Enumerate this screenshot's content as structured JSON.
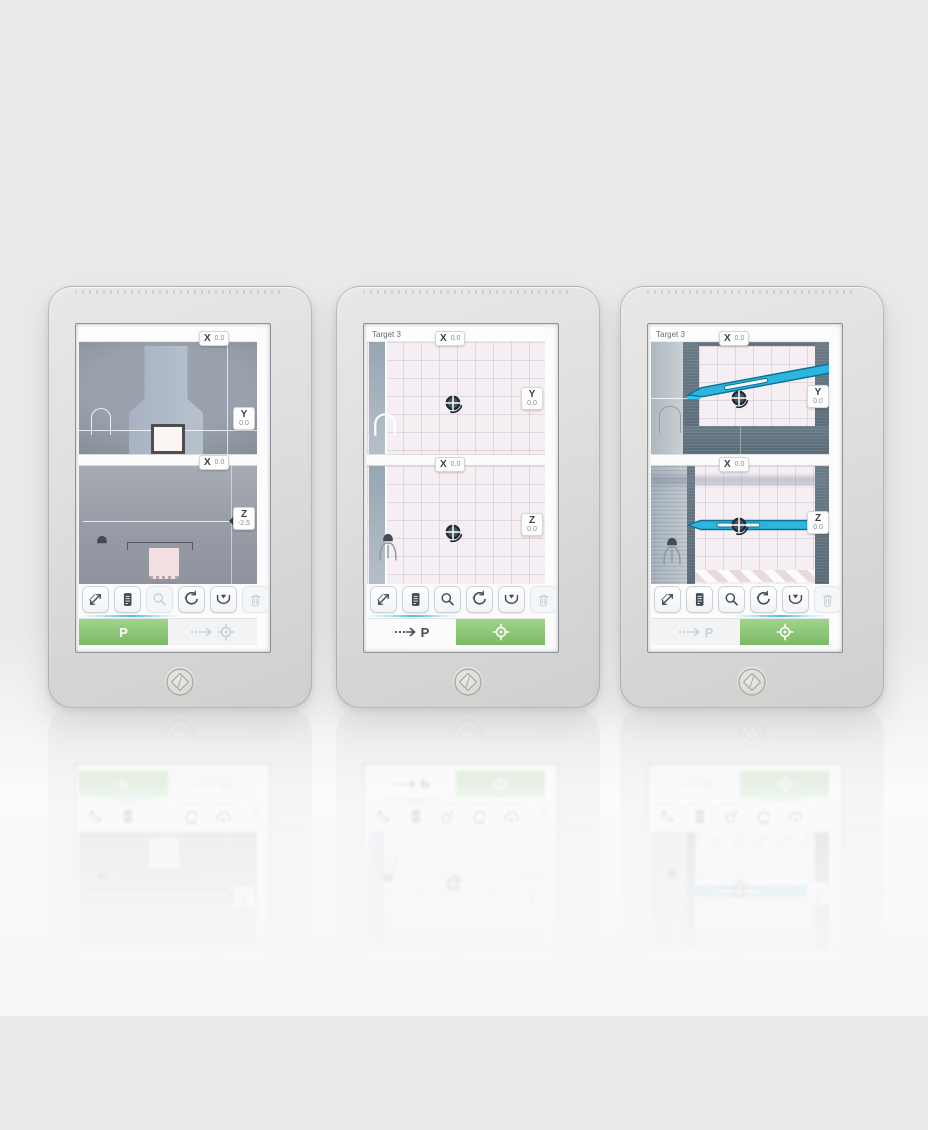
{
  "colors": {
    "accent_green": "#8CC878",
    "needle_blue": "#2CB6DE",
    "progress_cyan": "#49C3DE",
    "slate_frame": "#61727F",
    "grid_pink": "#F5EFF4",
    "body_gray": "#DEDEDC"
  },
  "icon_names": [
    "measure-icon",
    "document-icon",
    "magnifier-icon",
    "reset-icon",
    "capture-icon",
    "trash-icon",
    "dashed-arrow-icon",
    "crosshair-target-icon",
    "person-icon",
    "probe-arch-icon",
    "needle-graphic",
    "target-reticle-icon",
    "diamond-logo-icon"
  ],
  "devices": [
    {
      "title": "",
      "panels": [
        {
          "top_tag": {
            "label": "X",
            "value": "0.0"
          },
          "side_tag": {
            "label": "Y",
            "value": "0.0"
          }
        },
        {
          "top_tag": {
            "label": "X",
            "value": "0.0"
          },
          "side_tag": {
            "label": "Z",
            "value": "-2.5"
          }
        }
      ],
      "footer": {
        "probe_label": "P"
      }
    },
    {
      "title": "Target 3",
      "panels": [
        {
          "top_tag": {
            "label": "X",
            "value": "0.0"
          },
          "side_tag": {
            "label": "Y",
            "value": "0.0"
          }
        },
        {
          "top_tag": {
            "label": "X",
            "value": "0.0"
          },
          "side_tag": {
            "label": "Z",
            "value": "0.0"
          }
        }
      ],
      "footer": {
        "probe_label": "P"
      }
    },
    {
      "title": "Target 3",
      "panels": [
        {
          "top_tag": {
            "label": "X",
            "value": "0.0"
          },
          "side_tag": {
            "label": "Y",
            "value": "0.0"
          }
        },
        {
          "top_tag": {
            "label": "X",
            "value": "0.0"
          },
          "side_tag": {
            "label": "Z",
            "value": "0.0"
          }
        }
      ],
      "footer": {
        "probe_label": "P"
      }
    }
  ]
}
